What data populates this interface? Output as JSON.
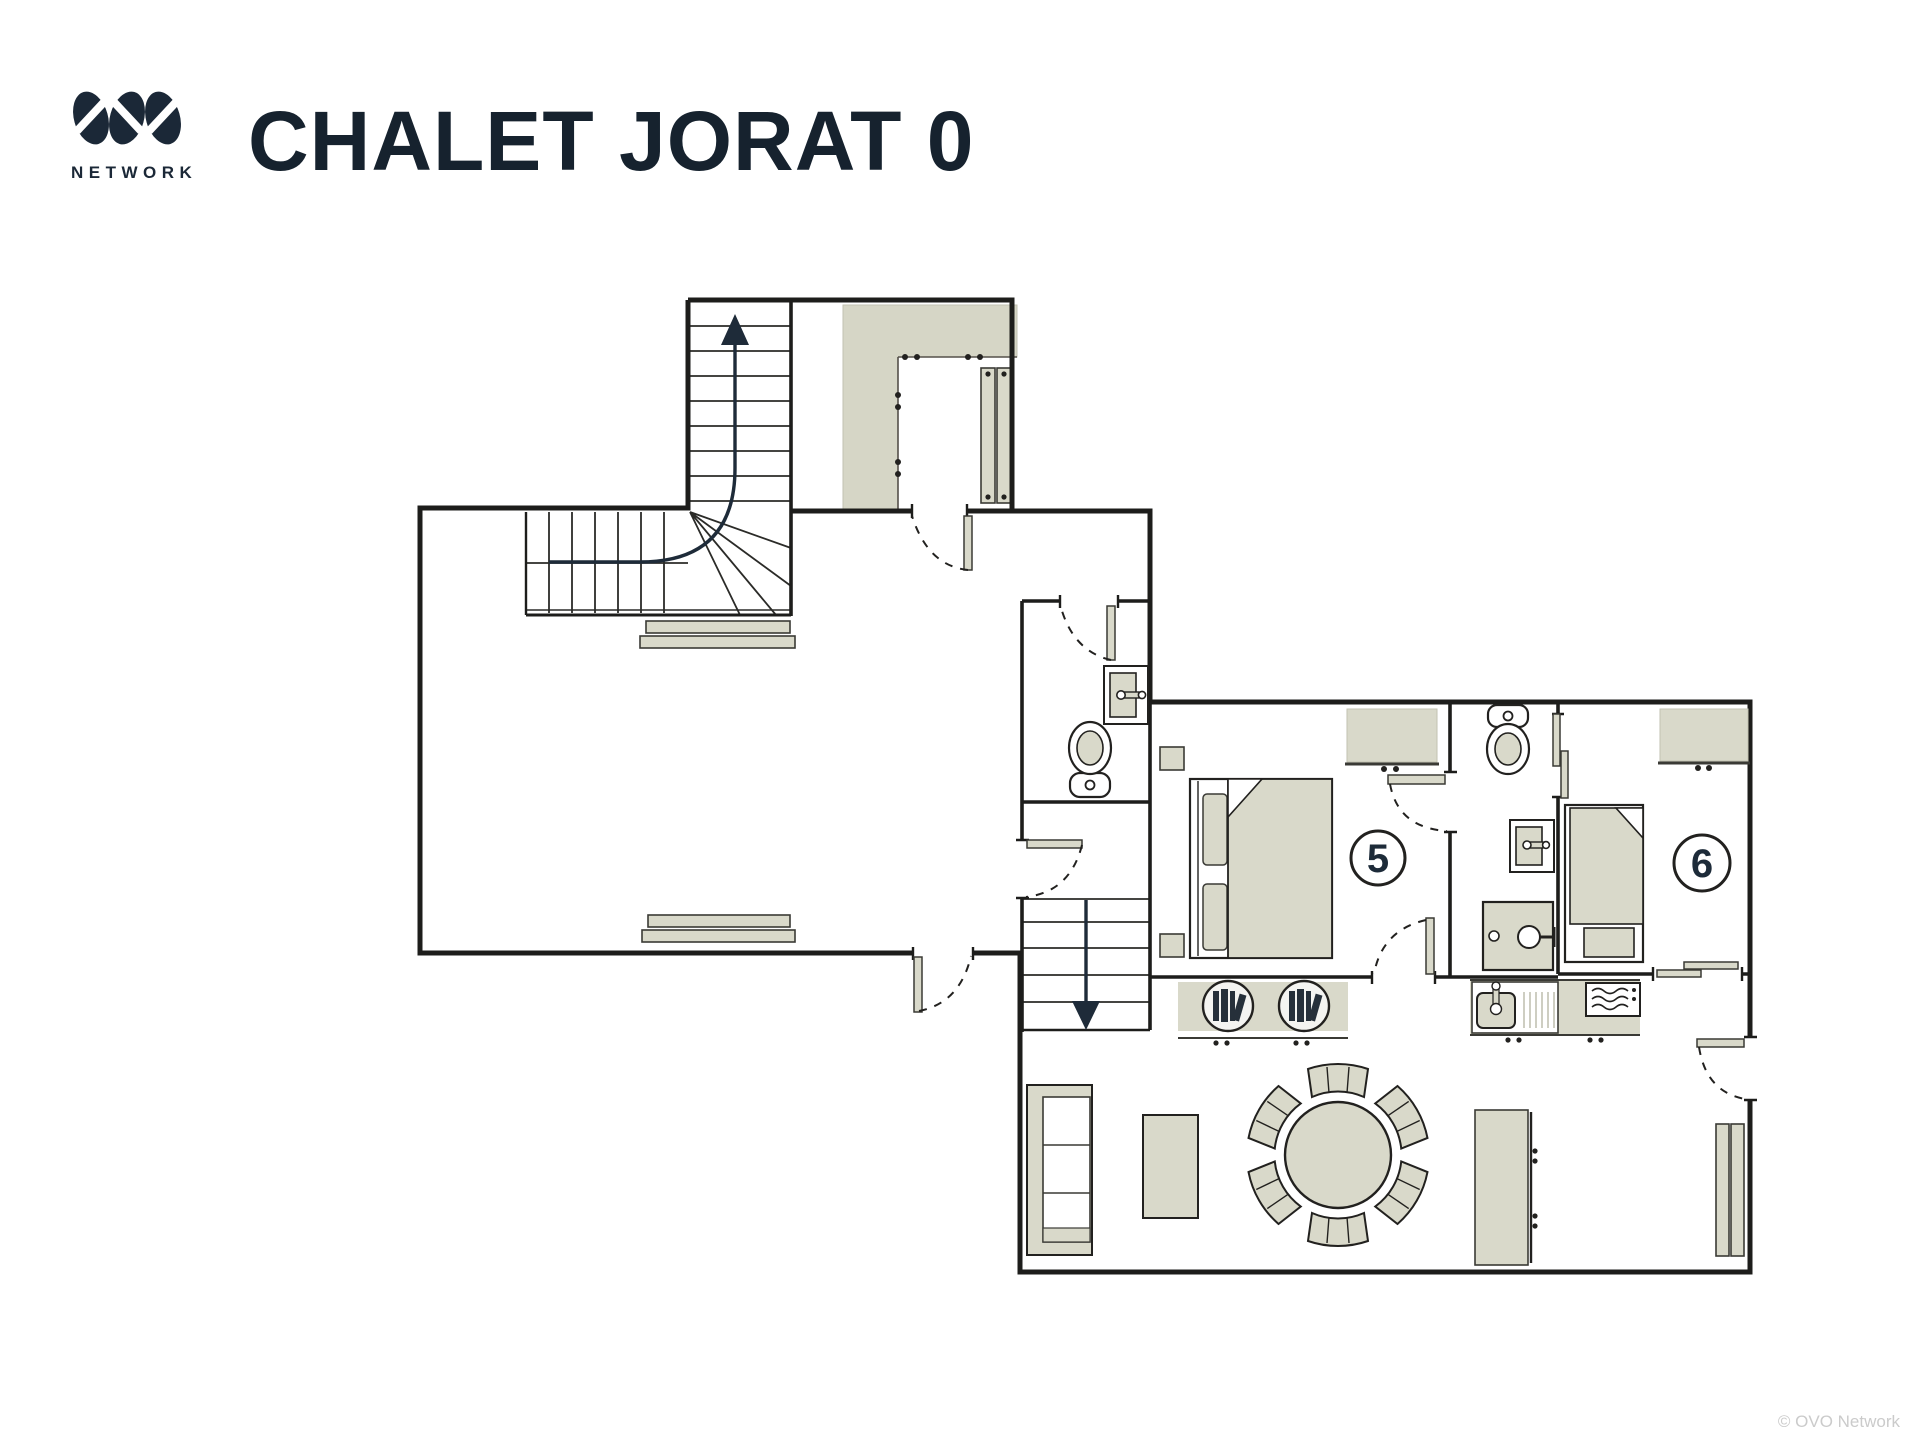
{
  "header": {
    "title": "CHALET JORAT 0",
    "logo_subtext": "NETWORK"
  },
  "footer": {
    "watermark": "© OVO Network"
  },
  "rooms": [
    {
      "id": "bedroom-5",
      "label": "5"
    },
    {
      "id": "bedroom-6",
      "label": "6"
    }
  ],
  "icons": [
    "ovo-logo-mark",
    "staircase-up-arrow",
    "staircase-down-arrow",
    "toilet",
    "washbasin",
    "shower",
    "double-bed",
    "single-bed",
    "wardrobe",
    "nightstand",
    "kitchen-sink",
    "microwave",
    "bookshelf",
    "sofa",
    "coffee-table",
    "round-dining-table",
    "dining-chair",
    "radiator",
    "bench",
    "door-swing",
    "sliding-door",
    "coat-closet"
  ],
  "colors": {
    "ink": "#1b2837",
    "wall": "#1d1d1b",
    "furniture_fill": "#d9d9ca",
    "closet_fill": "#d6d6c6",
    "outline": "#3a3a35",
    "watermark": "#cbcbcb"
  }
}
